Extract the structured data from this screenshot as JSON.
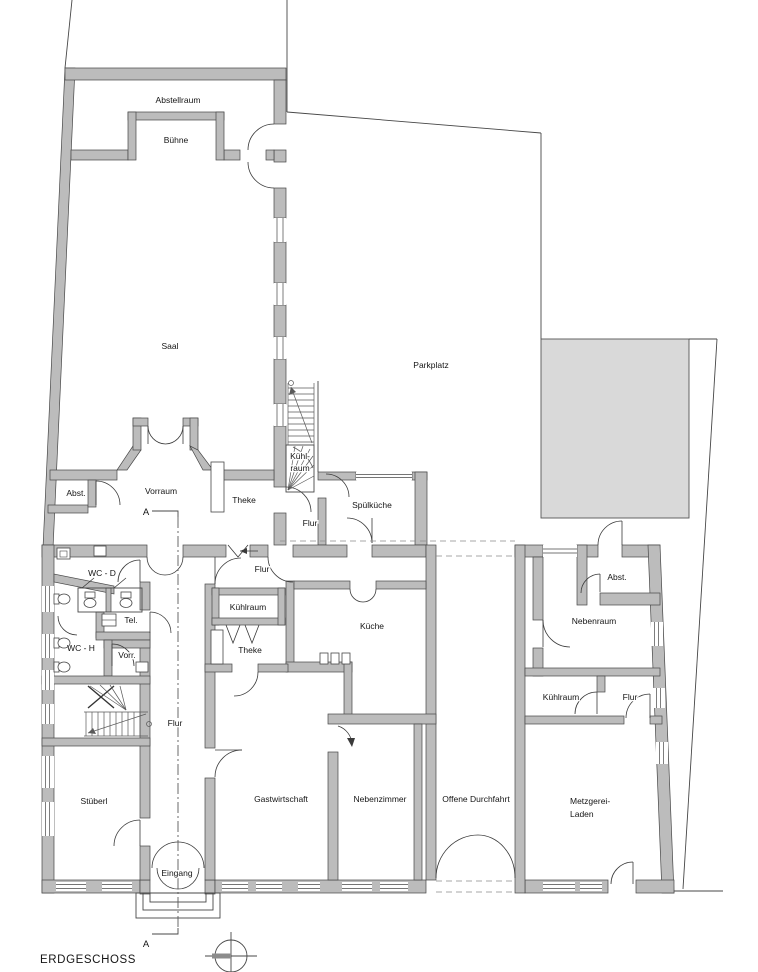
{
  "plan": {
    "title": "ERDGESCHOSS",
    "section_marker_top": "A",
    "section_marker_bottom": "A"
  },
  "rooms": {
    "abstellraum": "Abstellraum",
    "buehne": "Bühne",
    "saal": "Saal",
    "parkplatz": "Parkplatz",
    "abst_left": "Abst.",
    "vorraum": "Vorraum",
    "theke_saal": "Theke",
    "kuehlraum_stair": [
      "Kühl-",
      "raum"
    ],
    "flur_upper": "Flur",
    "spuelkueche": "Spülküche",
    "wc_d": "WC - D",
    "tel": "Tel.",
    "wc_h": "WC - H",
    "vorr": "Vorr.",
    "flur_service": "Flur",
    "kuehlraum_bar": "Kühlraum",
    "theke_bar": "Theke",
    "kueche": "Küche",
    "abst_right": "Abst.",
    "nebenraum": "Nebenraum",
    "kuehlraum_right": "Kühlraum",
    "flur_right": "Flur",
    "flur_main": "Flur",
    "stueberl": "Stüberl",
    "gastwirtschaft": "Gastwirtschaft",
    "nebenzimmer": "Nebenzimmer",
    "durchfahrt": "Offene Durchfahrt",
    "metzgerei": [
      "Metzgerei-",
      "Laden"
    ],
    "eingang": "Eingang"
  },
  "colors": {
    "wall": "#bcbcbc",
    "neighbor_block": "#d9d9d9",
    "line": "#474747",
    "text": "#151515"
  }
}
